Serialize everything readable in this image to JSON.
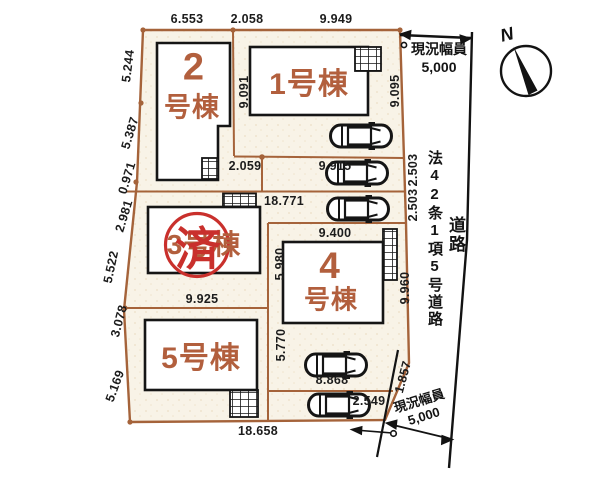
{
  "colors": {
    "boundary": "#a5633a",
    "building_label": "#b25f3d",
    "stamp_red": "#c9302c",
    "dim_text": "#1c1c1c",
    "parcel_fill": "#f8f3e7"
  },
  "compass": {
    "north_label": "N"
  },
  "buildings": {
    "b1": {
      "name": "1号棟"
    },
    "b2": {
      "digit": "2",
      "suffix": "号棟"
    },
    "b3": {
      "name": "3号棟"
    },
    "b4": {
      "digit": "4",
      "suffix": "号棟"
    },
    "b5": {
      "name": "5号棟"
    }
  },
  "stamp": {
    "text": "済"
  },
  "road": {
    "legal_label": "法42条1項5号道路",
    "road_label": "道路",
    "width_top": {
      "line1": "現況幅員",
      "line2": "5,000"
    },
    "width_bottom": {
      "line1": "現況幅員",
      "line2": "5,000"
    }
  },
  "dimensions": {
    "top": {
      "d6553": "6.553",
      "d2058": "2.058",
      "d9949": "9.949"
    },
    "left": {
      "d5244": "5.244",
      "d5387": "5.387",
      "d0971": "0.971",
      "d2981": "2.981",
      "d5522": "5.522",
      "d3078": "3.078",
      "d5169": "5.169"
    },
    "inner": {
      "d9091": "9.091",
      "d9095": "9.095",
      "d2059": "2.059",
      "d18771": "18.771",
      "d9915": "9.915",
      "d9925": "9.925",
      "d9400": "9.400",
      "d5980": "5.980",
      "d5770": "5.770",
      "d8868": "8.868",
      "d2549": "2.549",
      "d18658": "18.658"
    },
    "right": {
      "d2503a": "2.503",
      "d2503b": "2.503",
      "d9960": "9.960",
      "d1857": "1.857"
    }
  }
}
